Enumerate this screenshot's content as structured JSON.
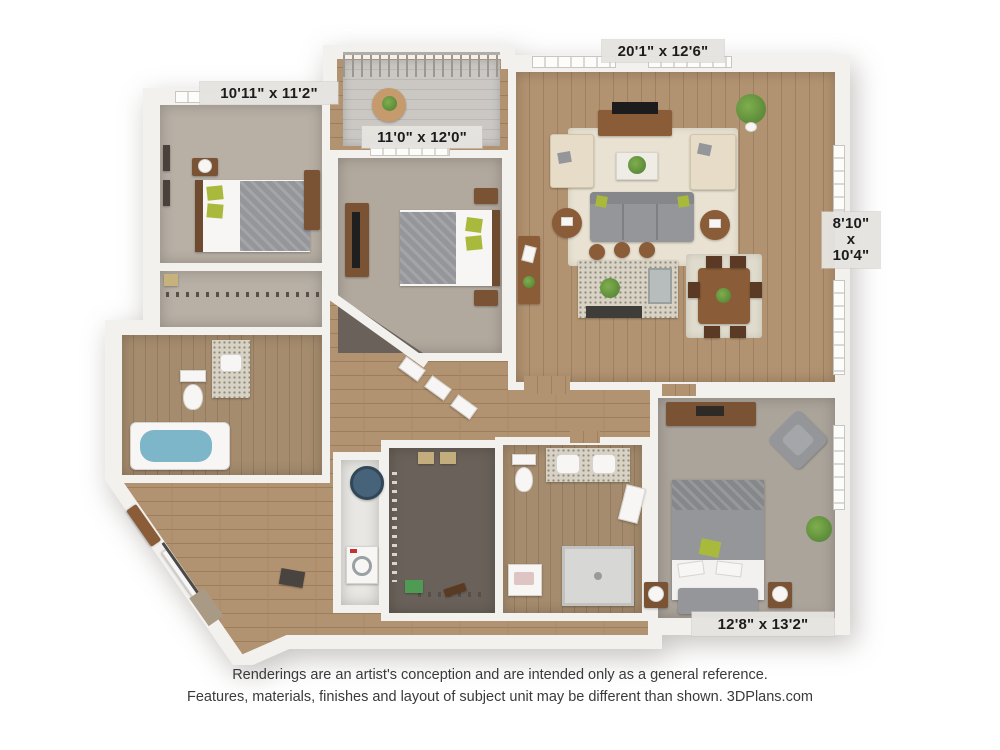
{
  "plan": {
    "labels": {
      "bedroom_top_left": "10'11\" x 11'2\"",
      "bedroom_middle": "11'0\" x 12'0\"",
      "living_room": "20'1\" x 12'6\"",
      "patio": {
        "line1": "8'10\"",
        "line2": "x",
        "line3": "10'4\""
      },
      "bedroom_bottom_right": "12'8\" x 13'2\""
    }
  },
  "footer": {
    "line1": "Renderings are an artist's conception and are intended only as a general reference.",
    "line2": "Features, materials, finishes and layout of subject unit may be different than shown. 3DPlans.com"
  },
  "colors": {
    "wall": "#f3f1ee",
    "wood_floor": "#b29371",
    "carpet": "#b2a99e",
    "accent_green": "#a9b93c",
    "label_background": "#e5e3e0"
  }
}
